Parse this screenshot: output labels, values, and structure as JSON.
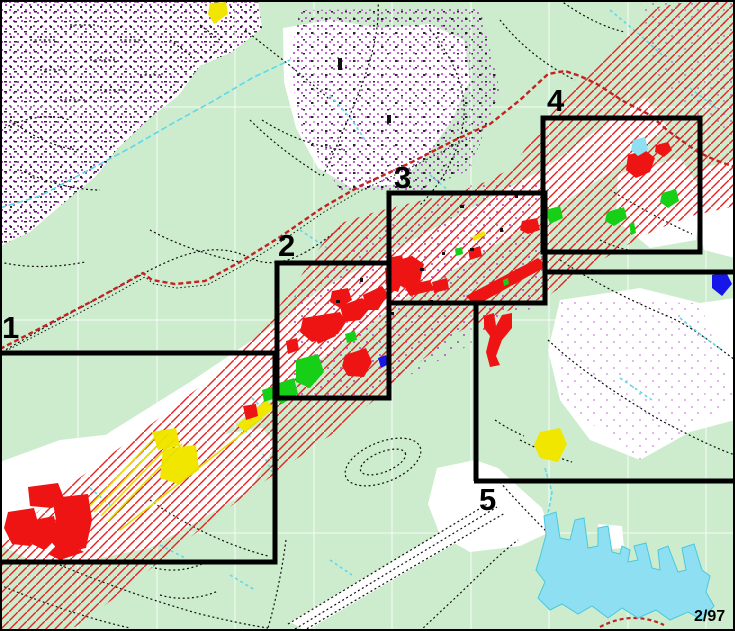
{
  "map": {
    "description": "Topographic index map with five numbered map-sheet outline boxes along a mining railroad corridor",
    "date_label": "2/97",
    "sheet_labels": [
      {
        "id": "sheet-1",
        "text": "1",
        "x": 2,
        "y": 312
      },
      {
        "id": "sheet-2",
        "text": "2",
        "x": 278,
        "y": 230
      },
      {
        "id": "sheet-3",
        "text": "3",
        "x": 394,
        "y": 162
      },
      {
        "id": "sheet-4",
        "text": "4",
        "x": 547,
        "y": 85
      },
      {
        "id": "sheet-5",
        "text": "5",
        "x": 479,
        "y": 484
      }
    ],
    "index_boxes": [
      {
        "id": "1",
        "x": -8,
        "y": 353,
        "w": 283,
        "h": 209
      },
      {
        "id": "2",
        "x": 277,
        "y": 263,
        "w": 112,
        "h": 135
      },
      {
        "id": "3",
        "x": 389,
        "y": 193,
        "w": 156,
        "h": 110
      },
      {
        "id": "4",
        "x": 543,
        "y": 118,
        "w": 157,
        "h": 134
      },
      {
        "id": "5",
        "x": 476,
        "y": 272,
        "w": 262,
        "h": 209
      }
    ],
    "colors": {
      "background_green": "#cdeccd",
      "cleared_white": "#ffffff",
      "urban_stipple_purple": "#b44cc8",
      "water_cyan": "#5fd8ec",
      "lake_fill": "#8fdff2",
      "disturbed_red": "#ee1414",
      "hatch_red": "#e22424",
      "spoil_yellow": "#f0e600",
      "reclaimed_green": "#18cf18",
      "impoundment_blue": "#1616e8",
      "index_box_black": "#000000",
      "railroad_dash_red": "#c42222"
    }
  }
}
